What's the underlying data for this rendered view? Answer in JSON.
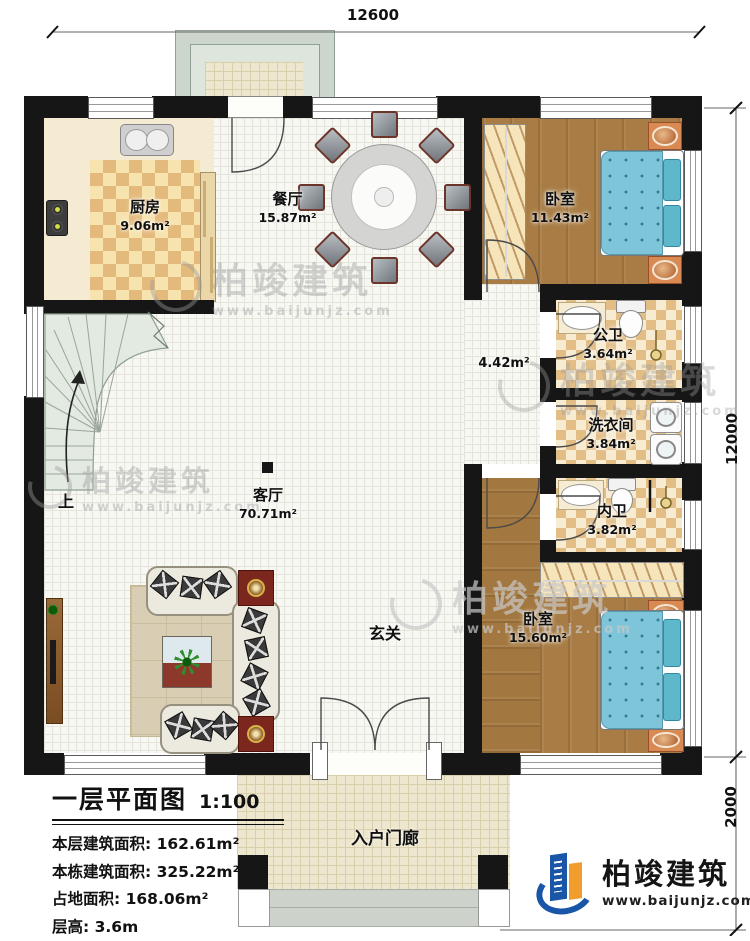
{
  "dimensions": {
    "top": "12600",
    "right_upper": "12000",
    "right_lower": "2000"
  },
  "rooms": {
    "kitchen": {
      "name": "厨房",
      "area": "9.06m²"
    },
    "dining": {
      "name": "餐厅",
      "area": "15.87m²"
    },
    "bedroom1": {
      "name": "卧室",
      "area": "11.43m²"
    },
    "public_bath": {
      "name": "公卫",
      "area": "3.64m²"
    },
    "laundry": {
      "name": "洗衣间",
      "area": "3.84m²"
    },
    "private_bath": {
      "name": "内卫",
      "area": "3.82m²"
    },
    "living": {
      "name": "客厅",
      "area": "70.71m²"
    },
    "bedroom2": {
      "name": "卧室",
      "area": "15.60m²"
    },
    "hall": {
      "area": "4.42m²"
    },
    "entry": {
      "name": "玄关"
    },
    "porch": {
      "name": "入户门廊"
    }
  },
  "stairs": {
    "up_label": "上"
  },
  "info": {
    "title": "一层平面图",
    "scale": "1:100",
    "rows": [
      {
        "label": "本层建筑面积:",
        "value": "162.61m²"
      },
      {
        "label": "本栋建筑面积:",
        "value": "325.22m²"
      },
      {
        "label": "占地面积:",
        "value": "168.06m²"
      },
      {
        "label": "层高:",
        "value": "3.6m"
      }
    ]
  },
  "branding": {
    "company": "柏竣建筑",
    "website": "www.baijunjz.com"
  },
  "watermark": {
    "company": "柏竣建筑",
    "website": "www.baijunjz.com"
  },
  "colors": {
    "wall": "#161616",
    "wood": "#a87c44",
    "bed": "#7fc5d9",
    "brand_blue": "#1a56a8",
    "brand_orange": "#f09d2e"
  }
}
